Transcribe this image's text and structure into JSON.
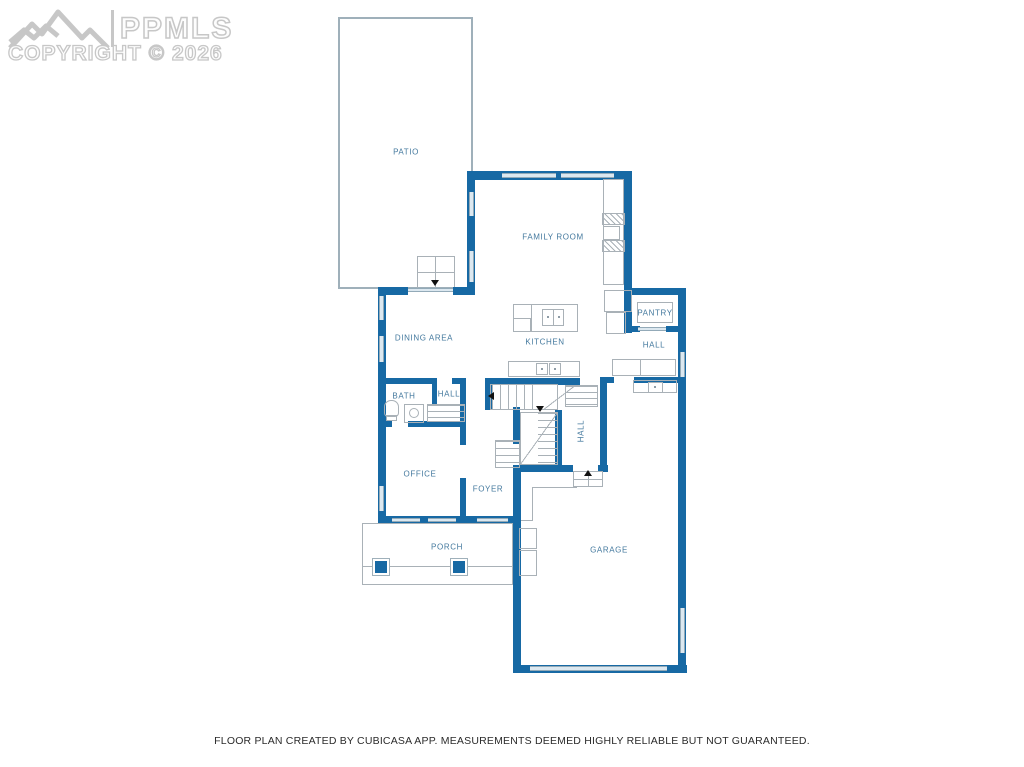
{
  "watermark": {
    "brand": "PPMLS",
    "copyright": "COPYRIGHT © 2026"
  },
  "rooms": {
    "patio": "PATIO",
    "family_room": "FAMILY ROOM",
    "dining_area": "DINING AREA",
    "kitchen": "KITCHEN",
    "pantry": "PANTRY",
    "hall_upper": "HALL",
    "bath": "BATH",
    "hall_bath": "HALL",
    "office": "OFFICE",
    "foyer": "FOYER",
    "hall_stairs": "HALL",
    "garage": "GARAGE",
    "porch": "PORCH"
  },
  "footer": {
    "disclaimer": "FLOOR PLAN CREATED BY CUBICASA APP. MEASUREMENTS DEEMED HIGHLY RELIABLE BUT NOT GUARANTEED."
  },
  "colors": {
    "wall": "#1769a4",
    "window": "#dce8f0",
    "thin": "#a9b1b7",
    "label": "#44799e",
    "watermark": "#c7c7c7",
    "footer": "#2b2b2b"
  }
}
